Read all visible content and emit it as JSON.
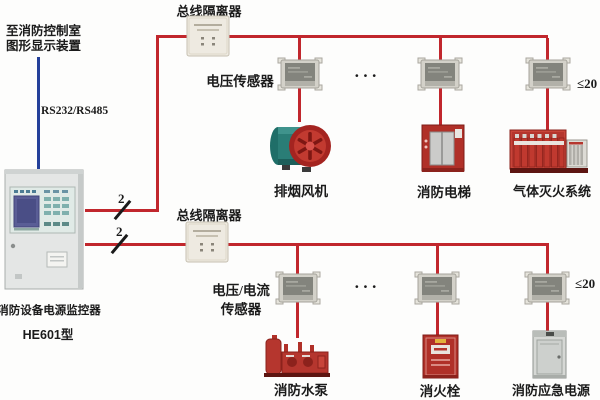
{
  "control_room": {
    "line1": "至消防控制室",
    "line2": "图形显示装置"
  },
  "serial_link": {
    "label": "RS232/RS485"
  },
  "monitor": {
    "name": "消防设备电源监控器",
    "model": "HE601型"
  },
  "bus1": {
    "isolator_label": "总线隔离器",
    "sensor_label": "电压传感器",
    "wire_count": "2",
    "ellipsis": "···",
    "limit_label": "≤20",
    "devices": [
      {
        "label": "排烟风机"
      },
      {
        "label": "消防电梯"
      },
      {
        "label": "气体灭火系统"
      }
    ]
  },
  "bus2": {
    "isolator_label": "总线隔离器",
    "sensor_label_line1": "电压/电流",
    "sensor_label_line2": "传感器",
    "wire_count": "2",
    "ellipsis": "···",
    "limit_label": "≤20",
    "devices": [
      {
        "label": "消防水泵"
      },
      {
        "label": "消火栓"
      },
      {
        "label": "消防应急电源"
      }
    ]
  },
  "icons": {
    "monitor_panel": "power-monitor-cabinet",
    "isolator": "bus-isolator-module",
    "sensor": "voltage-sensor-module",
    "fan": "smoke-exhaust-fan",
    "elevator": "fire-elevator",
    "gas_system": "gas-extinguishing-rack",
    "pump": "fire-pump-skid",
    "hydrant": "fire-hydrant-cabinet",
    "power_supply": "emergency-power-cabinet"
  },
  "colors": {
    "bus_line": "#c1272d",
    "serial_line": "#24409a",
    "text": "#1b1b1b"
  }
}
